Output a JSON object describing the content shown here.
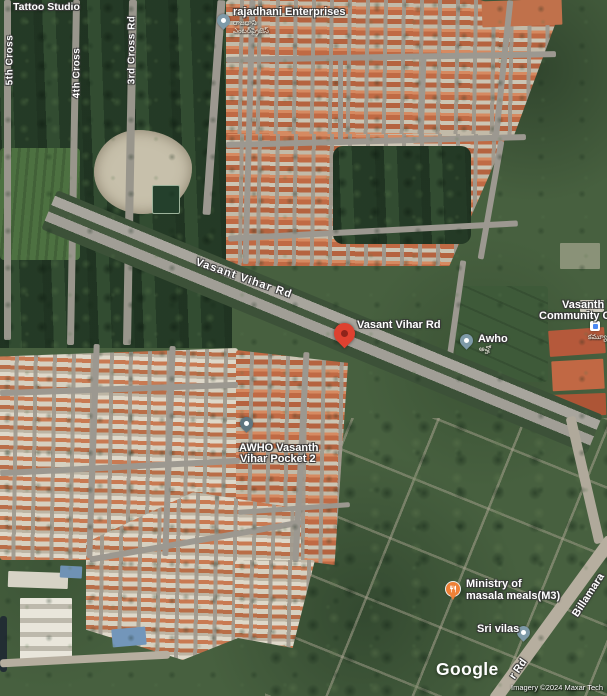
{
  "map": {
    "type": "satellite",
    "watermark_logo": "Google",
    "attribution": "Imagery ©2024 Maxar Tech"
  },
  "colors": {
    "pin_red": "#de4130",
    "pin_red_dot": "#8e231a",
    "pin_generic": "#7e9aa8",
    "pin_dark": "#5e7680",
    "pin_food": "#ef8137",
    "label_text": "#ffffff"
  },
  "road_labels": {
    "cross_5th": "5th Cross",
    "cross_4th": "4th Cross",
    "cross_3rd": "3rd Cross Rd",
    "vasant_vihar": "Vasant Vihar Rd",
    "billamara": "Billamara",
    "rd_fragment": "r Rd"
  },
  "pois": {
    "tattoo_studio": {
      "label": "Tattoo Studio"
    },
    "rajadhani": {
      "label": "rajadhani Enterprises",
      "sub": "రాజధాని ఎంటర్‌ప్రైజెస్"
    },
    "destination": {
      "label": "Vasant Vihar Rd"
    },
    "awho": {
      "label": "Awho",
      "sub": "అవ్హో"
    },
    "community_center": {
      "label_line1": "Vasanth V",
      "label_line2": "Community Cen",
      "sub": "కమ్యూనిటీ"
    },
    "awho_pocket": {
      "label_line1": "AWHO Vasanth",
      "label_line2": "Vihar Pocket 2"
    },
    "ministry_masala": {
      "label_line1": "Ministry of",
      "label_line2": "masala meals(M3)"
    },
    "sri_vilas": {
      "label": "Sri vilas"
    }
  }
}
